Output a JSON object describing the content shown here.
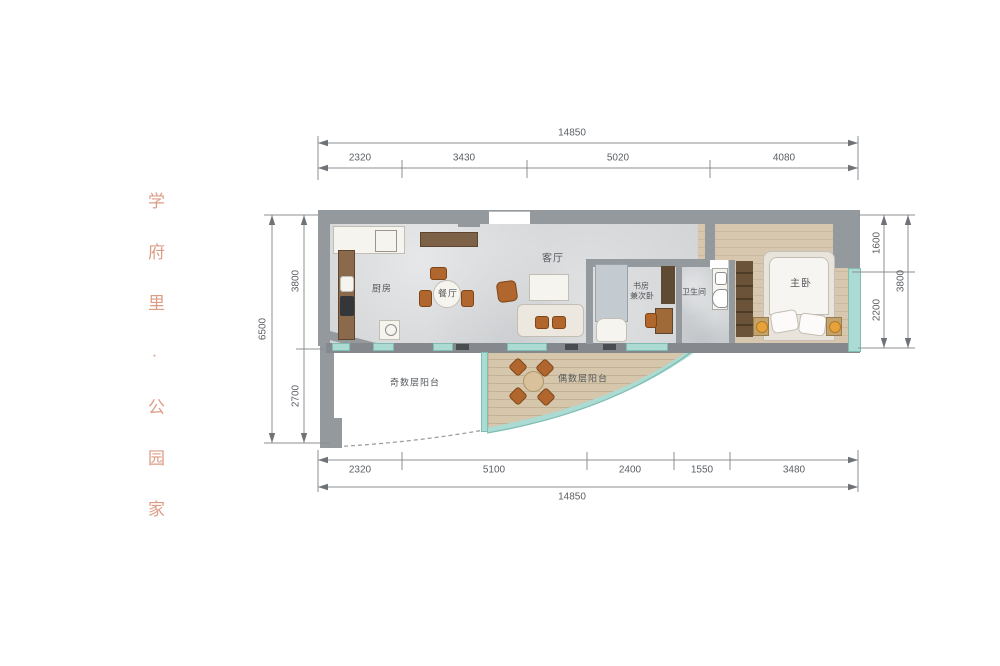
{
  "brand": {
    "vertical_text": "学府里·公园家"
  },
  "floor_plan": {
    "rooms": {
      "kitchen": {
        "label": "厨房"
      },
      "dining": {
        "label": "餐厅"
      },
      "living": {
        "label": "客厅"
      },
      "study": {
        "label_line1": "书房",
        "label_line2": "兼次卧"
      },
      "bathroom": {
        "label": "卫生间"
      },
      "master_bedroom": {
        "label": "主卧"
      },
      "balcony_odd": {
        "label": "奇数层阳台"
      },
      "balcony_even": {
        "label": "偶数层阳台"
      }
    }
  },
  "dimensions": {
    "top": {
      "total": "14850",
      "segments": [
        "2320",
        "3430",
        "5020",
        "4080"
      ]
    },
    "bottom": {
      "total": "14850",
      "segments": [
        "2320",
        "5100",
        "2400",
        "1550",
        "3480"
      ]
    },
    "left": {
      "total": "6500",
      "segments": [
        "3800",
        "2700"
      ]
    },
    "right": {
      "total": "3800",
      "segments": [
        "1600",
        "2200"
      ]
    }
  },
  "colors": {
    "brand_text": "#dd9c86",
    "wall": "#94999d",
    "marble_floor": "#d2d4d6",
    "wood_floor": "#d5c6ac",
    "window_teal": "#abdbd3",
    "furniture_orange": "#b0662c",
    "dimension_text": "#5b5f63"
  }
}
